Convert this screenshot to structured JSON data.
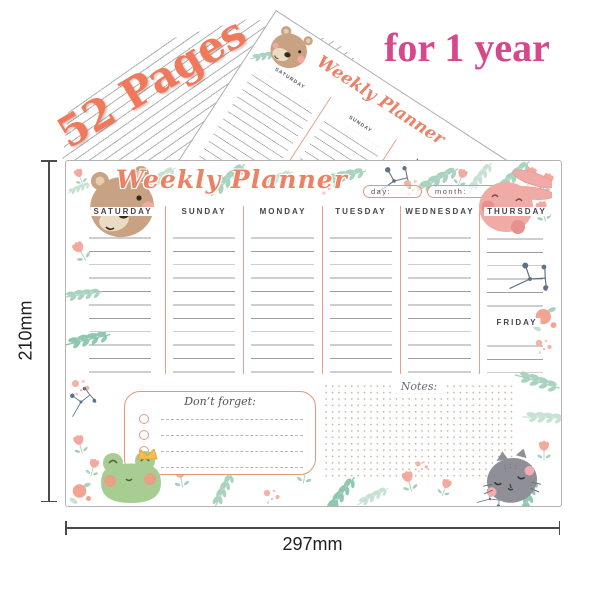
{
  "promo": {
    "pages_label": "52 Pages",
    "duration_label": "for 1 year"
  },
  "dimensions": {
    "height_label": "210mm",
    "width_label": "297mm"
  },
  "planner": {
    "title": "Weekly Planner",
    "day_field_label": "day:",
    "month_field_label": "month:",
    "columns": [
      "SATURDAY",
      "SUNDAY",
      "MONDAY",
      "TUESDAY",
      "WEDNESDAY",
      "THURSDAY"
    ],
    "friday_label": "FRIDAY",
    "dont_forget_title": "Don’t forget:",
    "notes_title": "Notes:",
    "checklist_rows": 4
  },
  "colors": {
    "title_coral": "#ED8166",
    "promo_coral": "#F0795C",
    "promo_pink": "#D6478C",
    "divider_coral": "#E9A08A",
    "box_coral": "#E6957B",
    "teal_leaf": "#A9D3BF",
    "mint_leaf": "#C7E2D4",
    "peach_dot": "#F5B3A3",
    "slate_berry": "#5E7388",
    "rule_gray": "#9E9E9E",
    "header_text": "#44444C",
    "bear_brown": "#C9A183",
    "bunny_pink": "#F0ABA6",
    "frog_green": "#A8CD93",
    "cat_gray": "#8F8F97"
  }
}
